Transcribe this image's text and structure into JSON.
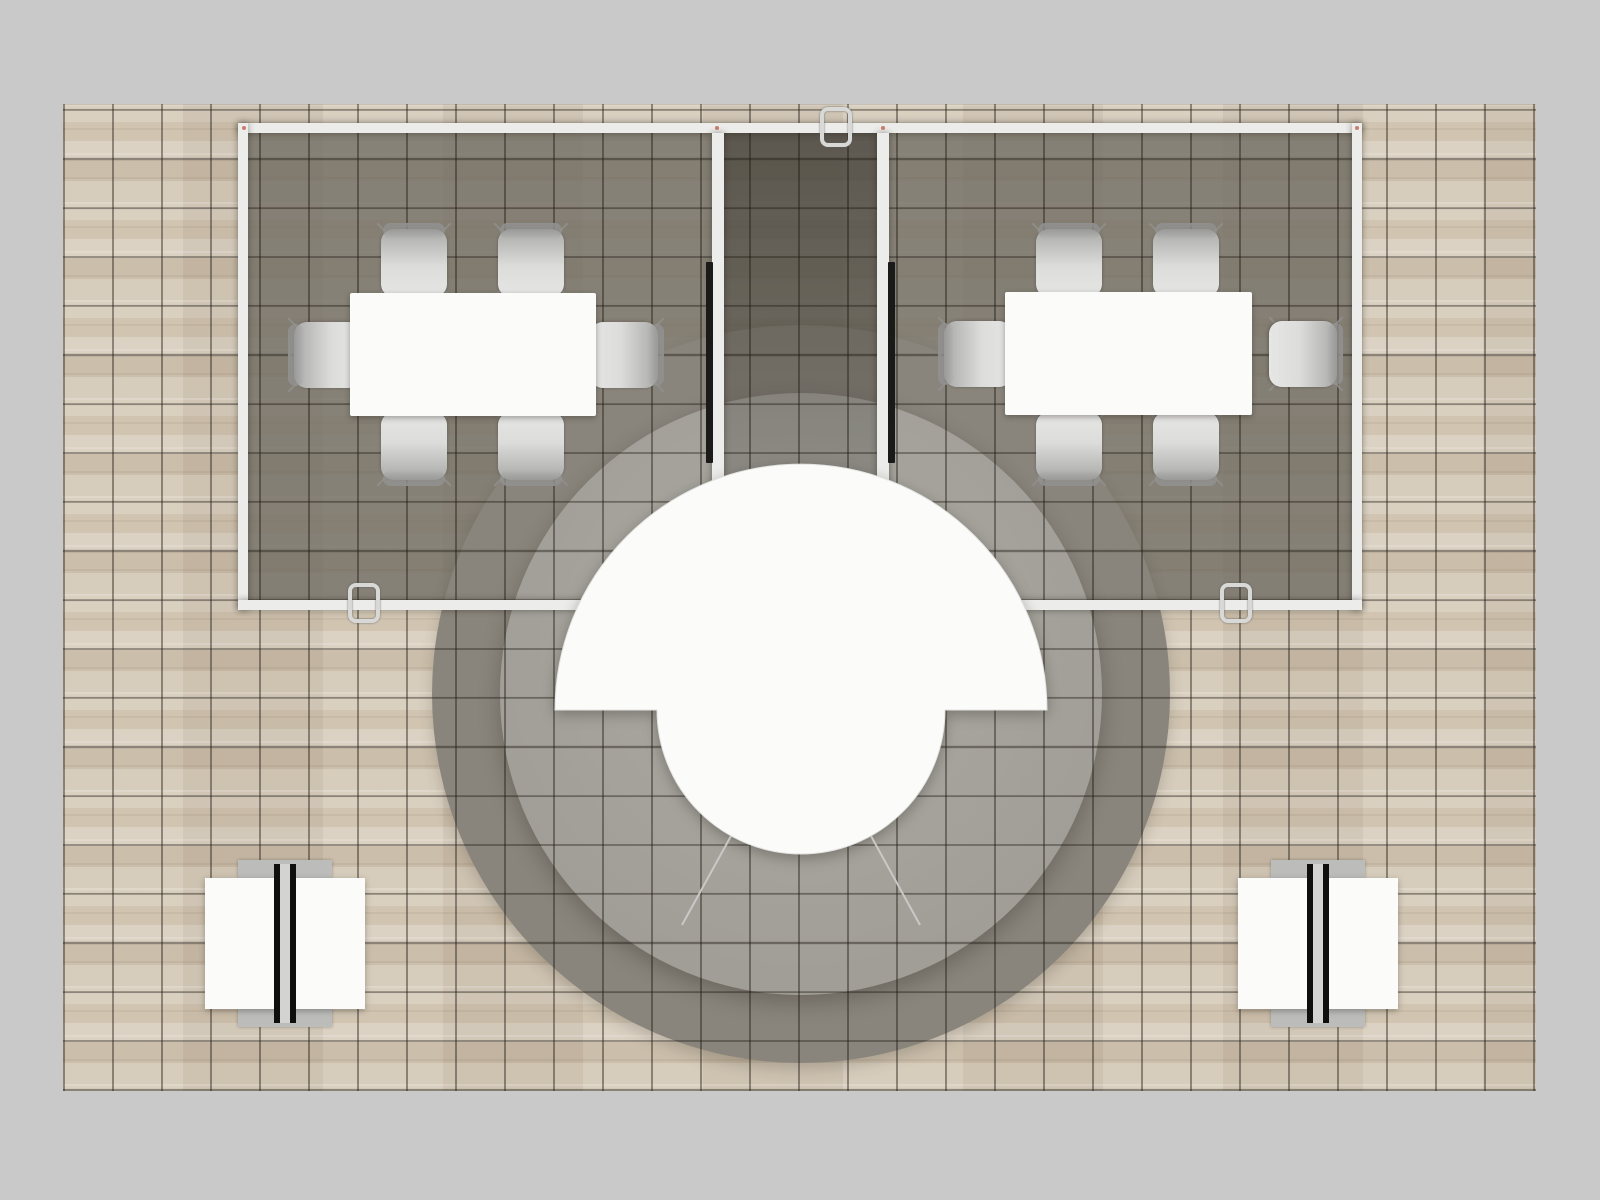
{
  "colors": {
    "bg": "#c9c9c9",
    "wood-base": "#d3c8b6",
    "tile-line": "rgba(28,24,16,0.42)",
    "booth-floor": "rgba(112,108,99,0.78)",
    "lounge-ring": "#8a857c",
    "carpet-a": "#acaaa4",
    "carpet-b": "#a09d96",
    "wall": "#ececea",
    "white": "#fbfbfa",
    "chair-light": "#dcdcdb",
    "chair-dark": "#a9a9a8",
    "chair-back": "#8f8f8e",
    "chair-leg": "#8f8f8d",
    "tv": "#1a1a18",
    "threshold": "#45433f",
    "clamp": "#d8d8d6",
    "marker": "#c2604f"
  },
  "floor": {
    "material": "light-oak-plank",
    "tile_grid_px": 49,
    "extent_px": {
      "left": 63,
      "top": 104,
      "width": 1473,
      "height": 987
    }
  },
  "booth": {
    "outer_walls_px": {
      "left": 238,
      "top": 123,
      "right": 1362,
      "bottom": 610
    },
    "meeting_rooms": [
      {
        "id": "left",
        "table_px": {
          "w": 246,
          "h": 123
        },
        "chairs": 6,
        "wall_display": true
      },
      {
        "id": "right",
        "table_px": {
          "w": 247,
          "h": 123
        },
        "chairs": 6,
        "wall_display": true
      }
    ],
    "corridor": {
      "width_px": 153,
      "open_end": "south",
      "threshold_bar": true
    },
    "lounge": {
      "ring_diameter_px": 738,
      "carpet_diameter_px": 602,
      "counter": {
        "shape": "half-ring",
        "outer_diameter_px": 492,
        "inner_diameter_px": 288,
        "segments": 3
      }
    },
    "demo_stations": [
      {
        "id": "bottom-left",
        "center_x_px": 285,
        "divider": "double-black-panel"
      },
      {
        "id": "bottom-right",
        "center_x_px": 1318,
        "divider": "double-black-panel"
      }
    ],
    "connector_clamps": 3,
    "junction_markers": 6
  }
}
